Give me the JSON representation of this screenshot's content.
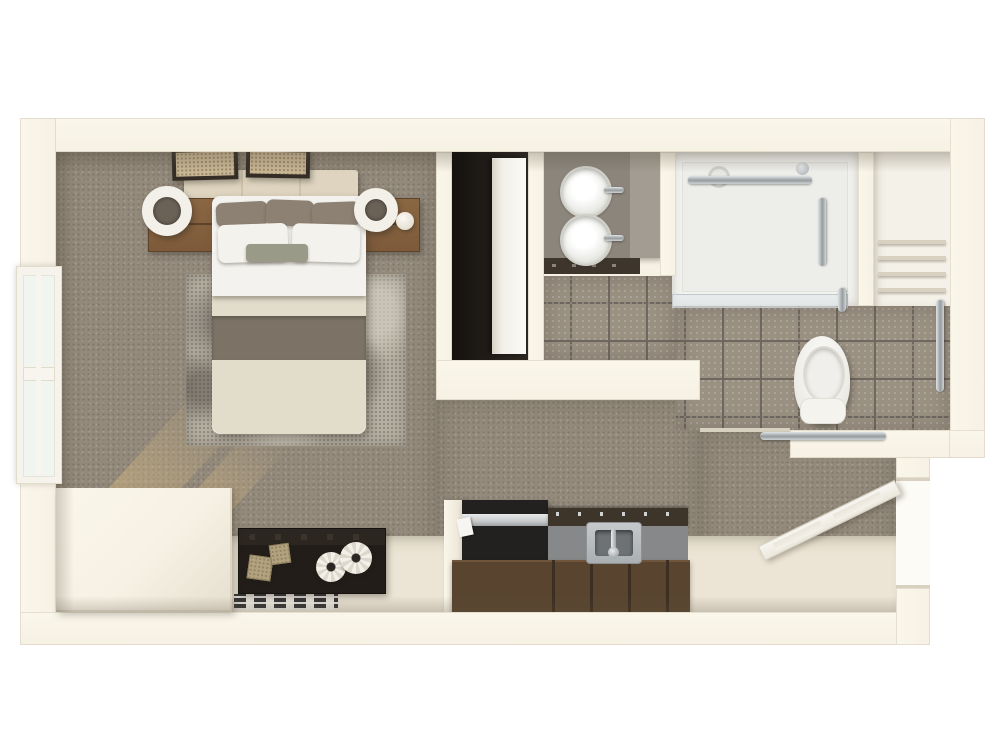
{
  "scene": {
    "name": "studio-apartment-3d-floor-plan-top-view",
    "background": "#ffffff",
    "rooms": [
      {
        "id": "bedroom_living",
        "name": "bedroom-living-area",
        "floor": "carpet"
      },
      {
        "id": "bathroom",
        "name": "accessible-bathroom",
        "floor": "tile"
      },
      {
        "id": "closet",
        "name": "wardrobe-closet"
      },
      {
        "id": "linen_niche",
        "name": "linen-shelf-niche"
      },
      {
        "id": "kitchenette",
        "name": "kitchenette"
      },
      {
        "id": "entry",
        "name": "entry-area"
      }
    ]
  },
  "palette": {
    "wall": "#f6f1e4",
    "wallBright": "#faf6ea",
    "wallShade": "#e6dfcf",
    "wallEdge": "#d8d1c0",
    "carpet": "#938a7c",
    "tile": "#9a9183",
    "grout": "#6f6860",
    "hardFloor": "#ece5d5",
    "wood": "#7d5a3a",
    "woodLight": "#8a6743",
    "darkWood": "#59452f",
    "woodSeam": "#3c2f22",
    "console": "#221d19",
    "consoleTop": "#2b2620",
    "counterDark": "#3e352a",
    "counterFace": "#868889",
    "stainless": "#c7c9ca",
    "chromeLight": "#dfe3e4",
    "chromeDark": "#969c9f",
    "linen": "#ded4bf",
    "pillowDark": "#8d8173",
    "sage": "#9a9a88",
    "sheet": "#f3f2ee",
    "duvet": "#e2dccb",
    "band": "#7c7366",
    "rug": "#b5aea1",
    "white": "#f4f2ed",
    "vanityTop": "#8c857c",
    "vanityTopLight": "#a39c92",
    "cabinet": "#3e362c",
    "glassEdge": "#c2c8cb",
    "artTan": "#c9b694",
    "frame": "#332d26",
    "doorWhite": "#f6f4ef"
  },
  "fixtures": {
    "window": {
      "name": "left-wall-window"
    },
    "bench": {
      "name": "window-ledge-enclosure"
    },
    "art_left": {
      "name": "framed-wall-art-left"
    },
    "art_right": {
      "name": "framed-wall-art-right"
    },
    "headboard": {
      "name": "upholstered-headboard"
    },
    "bed": {
      "name": "queen-bed"
    },
    "pillow_dark": {
      "name": "accent-pillow-taupe"
    },
    "pillow_white": {
      "name": "sleeping-pillow-white"
    },
    "lumbar": {
      "name": "lumbar-pillow-sage"
    },
    "nightstand_left": {
      "name": "nightstand-left"
    },
    "nightstand_right": {
      "name": "nightstand-right"
    },
    "lamp_left": {
      "name": "drum-lamp-left"
    },
    "lamp_right": {
      "name": "drum-lamp-right"
    },
    "sphere": {
      "name": "decor-sphere"
    },
    "rug": {
      "name": "distressed-area-rug"
    },
    "console": {
      "name": "media-console"
    },
    "cube_a": {
      "name": "decor-cube-large"
    },
    "cube_b": {
      "name": "decor-cube-small"
    },
    "gear_a": {
      "name": "decor-gear-left"
    },
    "gear_b": {
      "name": "decor-gear-right"
    },
    "mat": {
      "name": "striped-accent-mat"
    },
    "closet_door": {
      "name": "closet-sliding-door"
    },
    "fridge": {
      "name": "under-counter-refrigerator"
    },
    "counter": {
      "name": "kitchen-counter"
    },
    "ksink": {
      "name": "kitchen-sink"
    },
    "cabinets": {
      "name": "kitchen-cabinet-front"
    },
    "vanity": {
      "name": "double-sink-vanity"
    },
    "vsink_top": {
      "name": "vanity-sink-upper"
    },
    "vsink_bottom": {
      "name": "vanity-sink-lower"
    },
    "shower": {
      "name": "roll-in-shower"
    },
    "glass": {
      "name": "shower-glass-panel"
    },
    "towel_bar": {
      "name": "shower-towel-bar"
    },
    "shower_bar": {
      "name": "shower-grab-bar"
    },
    "drain": {
      "name": "shower-drain"
    },
    "head": {
      "name": "shower-head"
    },
    "toilet": {
      "name": "accessible-toilet"
    },
    "tbar_h": {
      "name": "toilet-grab-bar-horizontal"
    },
    "tbar_v": {
      "name": "toilet-grab-bar-vertical"
    },
    "shelves": {
      "name": "linen-shelves"
    },
    "door": {
      "name": "entry-door-open"
    },
    "doorway": {
      "name": "entry-doorway"
    }
  }
}
